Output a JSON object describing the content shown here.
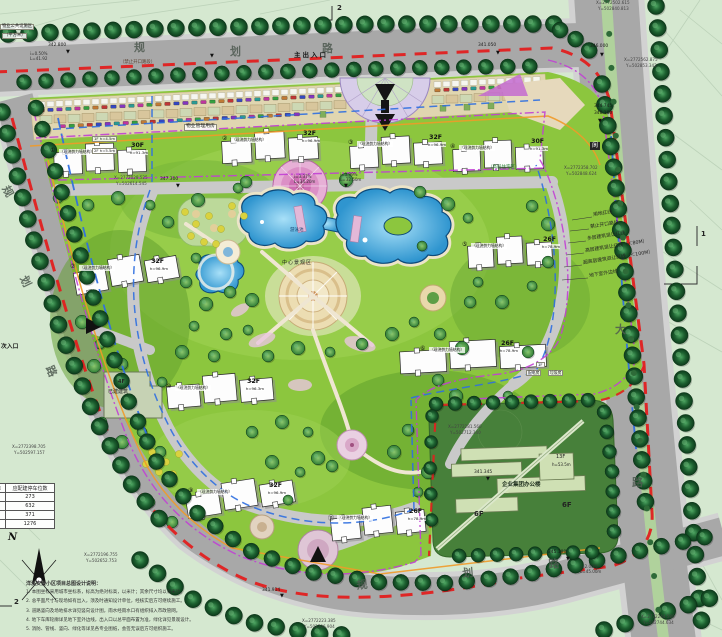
{
  "colors": {
    "boundary_red": "#e11f1f",
    "setback_magenta": "#c13fd4",
    "underground_blue": "#2f6fe0",
    "utility_orange": "#f09a28",
    "lawn_green": "#8cc63e",
    "water_blue": "#3aa5dd",
    "road_gray": "#a8a8a8",
    "tree_dark": "#1c5a2e",
    "office_green": "#47803a"
  },
  "north": {
    "label": "N"
  },
  "sections": {
    "top": "2",
    "right": "1",
    "bottom_left": "2"
  },
  "labels": {
    "pool": "游泳池",
    "center": "中心景观区",
    "zone": "（高层住宅区）",
    "mgmt": "物业管理用房",
    "shop1": "1F h=4.5m",
    "shop2": "2F h=5.5m",
    "exist_f": "4F",
    "exist": "已建建筑",
    "power_f": "1F",
    "power": "配电房",
    "trash": "垃圾房",
    "corner1": "物业公共设施区",
    "corner2": "（平方米）"
  },
  "office": {
    "name": "企业集团办公楼",
    "tower": "13F",
    "tower_h": "h=53.5m",
    "podium_a": "6F",
    "podium_b": "6F"
  },
  "parking_table": {
    "col1": "标准",
    "col2": "应配建停车位数",
    "rows": [
      {
        "v": "273"
      },
      {
        "v": "632"
      },
      {
        "v": "371"
      },
      {
        "v": "1276"
      }
    ]
  },
  "notes": {
    "title": "洋溪安置小区项目总图设计说明：",
    "items": [
      {
        "t": "1. 本图坐标采用城市坐标系，标高为绝对标高，以米计；其余尺寸均以毫米计。"
      },
      {
        "t": "2. 总平面尺寸与现场如有出入，须及时通知设计单位，经核实后方可继续施工。"
      },
      {
        "t": "3. 道路竖向及场地排水详见竖向设计图，雨水经雨水口有组织排入市政管网。"
      },
      {
        "t": "4. 地下车库轮廓详见地下室外边线，出入口以总平面布置为准，绿化详见景观设计。"
      },
      {
        "t": "5. 消防、管线、竖向、绿化等详见各专业图纸，会签无误后方可组织施工。"
      }
    ]
  },
  "legend_items": [
    {
      "t": "用地红线",
      "x": 593,
      "y": 214,
      "rot": -9,
      "cls": "leg"
    },
    {
      "t": "禁止开口路段",
      "x": 590,
      "y": 226,
      "rot": -9,
      "cls": "leg"
    },
    {
      "t": "多层建筑退让红线",
      "x": 587,
      "y": 238,
      "rot": -9,
      "cls": "leg"
    },
    {
      "t": "高层建筑退让红线（＜80M）",
      "x": 585,
      "y": 250,
      "rot": -9,
      "cls": "leg"
    },
    {
      "t": "超高层建筑退让红线（＜100M）",
      "x": 583,
      "y": 262,
      "rot": -9,
      "cls": "leg"
    },
    {
      "t": "地下室外边线",
      "x": 589,
      "y": 275,
      "rot": -9,
      "cls": "leg"
    }
  ],
  "buildings": [
    {
      "num": "①",
      "struct": "（现浇剪力墙结构）",
      "floors": "30F",
      "h": "h=91.3m",
      "x": 50,
      "y": 142
    },
    {
      "num": "②",
      "struct": "（现浇剪力墙结构）",
      "floors": "32F",
      "h": "h=96.9m",
      "x": 222,
      "y": 130
    },
    {
      "num": "③",
      "struct": "（现浇剪力墙结构）",
      "floors": "32F",
      "h": "h=96.9m",
      "x": 348,
      "y": 134
    },
    {
      "num": "④",
      "struct": "（现浇剪力墙结构）",
      "floors": "30F",
      "h": "h=91.3m",
      "x": 450,
      "y": 138
    },
    {
      "num": "⑤",
      "struct": "（现浇剪力墙结构）",
      "floors": "26F",
      "h": "h=78.9m",
      "x": 462,
      "y": 236
    },
    {
      "num": "⑥",
      "struct": "（现浇剪力墙结构）",
      "floors": "26F",
      "h": "h=78.9m",
      "x": 420,
      "y": 340
    },
    {
      "num": "⑦",
      "struct": "（现浇剪力墙结构）",
      "floors": "32F",
      "h": "h=96.9m",
      "x": 70,
      "y": 258
    },
    {
      "num": "⑩",
      "struct": "（现浇剪力墙结构）",
      "floors": "32F",
      "h": "h=96.3m",
      "x": 166,
      "y": 378
    },
    {
      "num": "⑨",
      "struct": "（现浇剪力墙结构）",
      "floors": "32F",
      "h": "h=96.9m",
      "x": 188,
      "y": 482
    },
    {
      "num": "⑪",
      "struct": "（现浇剪力墙结构）",
      "floors": "26F",
      "h": "h=78.9m",
      "x": 328,
      "y": 508
    }
  ],
  "annotations": [
    {
      "t": "规",
      "x": 134,
      "y": 42,
      "cls": "rdname2"
    },
    {
      "t": "划",
      "x": 230,
      "y": 46,
      "cls": "rdname2"
    },
    {
      "t": "路",
      "x": 322,
      "y": 43,
      "cls": "rdname2"
    },
    {
      "t": "主出入口",
      "x": 294,
      "y": 52,
      "cls": "ent"
    },
    {
      "t": "（禁止开口路段）",
      "x": 120,
      "y": 61,
      "cls": "forbid"
    },
    {
      "t": "规",
      "x": 10,
      "y": 184,
      "rot": 62,
      "cls": "rdname2"
    },
    {
      "t": "划",
      "x": 28,
      "y": 274,
      "rot": 64,
      "cls": "rdname2"
    },
    {
      "t": "路",
      "x": 54,
      "y": 364,
      "rot": 66,
      "cls": "rdname2"
    },
    {
      "t": "次入口",
      "x": 1,
      "y": 345,
      "cls": "ent2"
    },
    {
      "t": "规",
      "x": 356,
      "y": 580,
      "rot": -6,
      "cls": "rdname2"
    },
    {
      "t": "划",
      "x": 462,
      "y": 568,
      "rot": -5,
      "cls": "rdname2"
    },
    {
      "t": "路",
      "x": 548,
      "y": 559,
      "rot": -4,
      "cls": "rdname2"
    },
    {
      "t": "大",
      "x": 615,
      "y": 324,
      "cls": "rdname2"
    },
    {
      "t": "路",
      "x": 632,
      "y": 477,
      "cls": "rdname2"
    },
    {
      "t": "阆",
      "x": 590,
      "y": 142,
      "cls": "box"
    },
    {
      "t": "342.800",
      "x": 48,
      "y": 44,
      "cls": "lvl"
    },
    {
      "t": "▼",
      "x": 66,
      "y": 50,
      "cls": "mark"
    },
    {
      "t": "i=0.50%",
      "x": 30,
      "y": 52,
      "cls": "slope"
    },
    {
      "t": "L=41.92",
      "x": 30,
      "y": 57,
      "cls": "slope"
    },
    {
      "t": "▼",
      "x": 210,
      "y": 54,
      "cls": "mark"
    },
    {
      "t": "341.050",
      "x": 478,
      "y": 44,
      "cls": "lvl"
    },
    {
      "t": "▼",
      "x": 496,
      "y": 51,
      "cls": "mark"
    },
    {
      "t": "346.000",
      "x": 590,
      "y": 45,
      "cls": "lvl"
    },
    {
      "t": "▼",
      "x": 600,
      "y": 53,
      "cls": "mark"
    },
    {
      "t": "344.745",
      "x": 594,
      "y": 105,
      "cls": "lvl"
    },
    {
      "t": "340.100",
      "x": 594,
      "y": 112,
      "cls": "lvl"
    },
    {
      "t": "▼",
      "x": 598,
      "y": 119,
      "cls": "mark"
    },
    {
      "t": "X=2772502.615",
      "x": 596,
      "y": 1,
      "cls": "coord"
    },
    {
      "t": "Y=502840.813",
      "x": 598,
      "y": 7,
      "cls": "coord"
    },
    {
      "t": "X=2772562.875",
      "x": 624,
      "y": 58,
      "cls": "coord"
    },
    {
      "t": "Y=502853.342",
      "x": 626,
      "y": 64,
      "cls": "coord"
    },
    {
      "t": "X=2772358.702",
      "x": 564,
      "y": 166,
      "cls": "coord"
    },
    {
      "t": "Y=502848.624",
      "x": 566,
      "y": 172,
      "cls": "coord"
    },
    {
      "t": "X=2772028.525",
      "x": 114,
      "y": 176,
      "cls": "coord"
    },
    {
      "t": "Y=502614.545",
      "x": 116,
      "y": 182,
      "cls": "coord"
    },
    {
      "t": "347.300",
      "x": 160,
      "y": 178,
      "cls": "lvl"
    },
    {
      "t": "▼",
      "x": 176,
      "y": 184,
      "cls": "mark"
    },
    {
      "t": "i=3.37%",
      "x": 294,
      "y": 175,
      "cls": "slope"
    },
    {
      "t": "L=34.20m",
      "x": 294,
      "y": 180,
      "cls": "slope"
    },
    {
      "t": "i=3.99%",
      "x": 340,
      "y": 173,
      "cls": "slope"
    },
    {
      "t": "L=32.60m",
      "x": 340,
      "y": 178,
      "cls": "slope"
    },
    {
      "t": "▼",
      "x": 344,
      "y": 184,
      "cls": "mark"
    },
    {
      "t": "X=2772398.705",
      "x": 12,
      "y": 445,
      "cls": "coord"
    },
    {
      "t": "Y=502597.157",
      "x": 14,
      "y": 451,
      "cls": "coord"
    },
    {
      "t": "X=2772196.755",
      "x": 84,
      "y": 553,
      "cls": "coord"
    },
    {
      "t": "Y=502652.753",
      "x": 86,
      "y": 559,
      "cls": "coord"
    },
    {
      "t": "341.914",
      "x": 262,
      "y": 589,
      "cls": "lvl"
    },
    {
      "t": "▼",
      "x": 280,
      "y": 594,
      "cls": "mark"
    },
    {
      "t": "345.188",
      "x": 548,
      "y": 551,
      "cls": "lvl"
    },
    {
      "t": "▼",
      "x": 566,
      "y": 557,
      "cls": "mark"
    },
    {
      "t": "i=2.00%",
      "x": 580,
      "y": 565,
      "cls": "slope"
    },
    {
      "t": "L=45.00m",
      "x": 580,
      "y": 570,
      "cls": "slope"
    },
    {
      "t": "X=2772223.385",
      "x": 302,
      "y": 619,
      "cls": "coord"
    },
    {
      "t": "Y=502706.904",
      "x": 304,
      "y": 625,
      "cls": "coord"
    },
    {
      "t": "X=2772244.580",
      "x": 641,
      "y": 615,
      "cls": "coord"
    },
    {
      "t": "Y=502744.634",
      "x": 643,
      "y": 621,
      "cls": "coord"
    },
    {
      "t": "X=2772281.560",
      "x": 448,
      "y": 425,
      "cls": "coord"
    },
    {
      "t": "Y=502712.340",
      "x": 450,
      "y": 431,
      "cls": "coord"
    },
    {
      "t": "341.345",
      "x": 474,
      "y": 471,
      "cls": "lvl"
    },
    {
      "t": "▼",
      "x": 486,
      "y": 477,
      "cls": "mark"
    }
  ]
}
